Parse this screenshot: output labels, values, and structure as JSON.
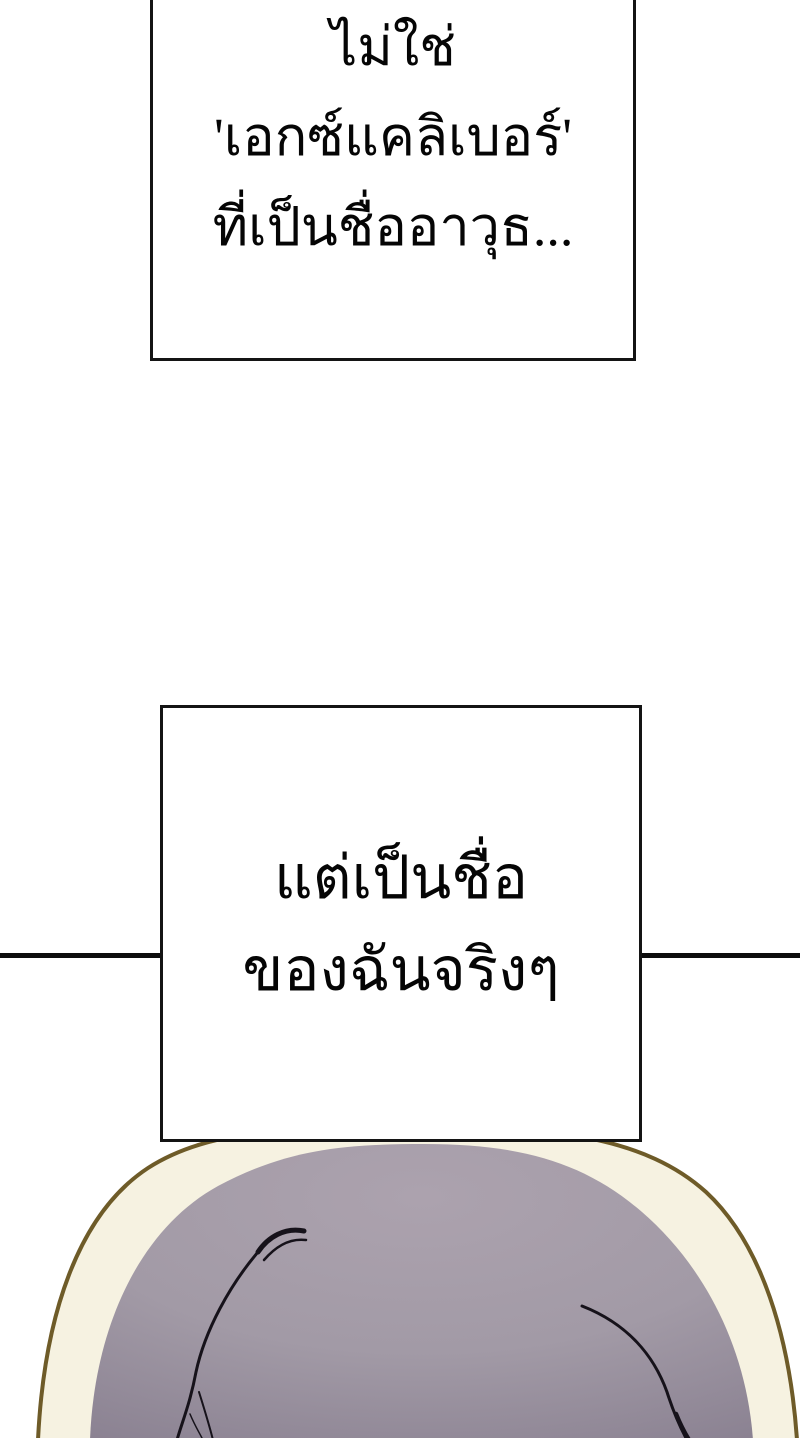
{
  "page": {
    "background": "#ffffff"
  },
  "divider": {
    "color": "#0d0d0d"
  },
  "frame": {
    "border_color": "#141414"
  },
  "speech": {
    "box_top": {
      "lines": [
        "ไม่ใช่",
        "'เอกซ์แคลิเบอร์'",
        "ที่เป็นชื่ออาวุธ..."
      ]
    },
    "box_middle": {
      "lines": [
        "แต่เป็นชื่อ",
        "ของฉันจริงๆ"
      ]
    }
  },
  "artwork": {
    "hair_highlight": "#aca2ae",
    "hair_base": "#a２9aa6",
    "hair_shadow": "#8b8292",
    "halo_fill": "#f6f2e1",
    "halo_outline": "#6e5b28",
    "strand_color": "#16121a"
  }
}
